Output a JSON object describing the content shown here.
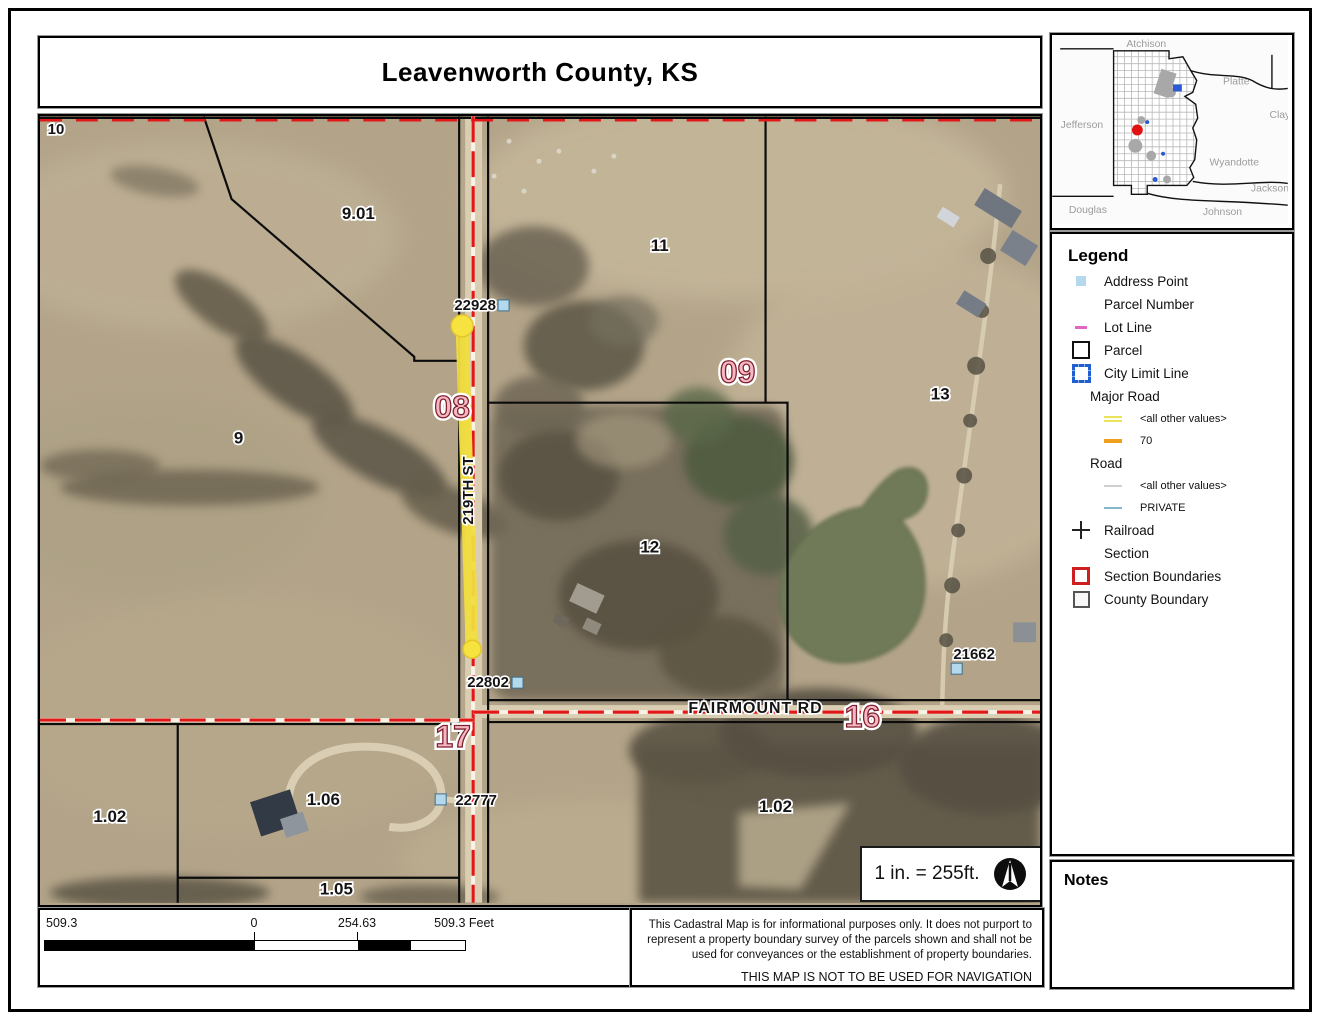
{
  "title": "Leavenworth County, KS",
  "inset": {
    "counties": [
      "Atchison",
      "Platte",
      "Jefferson",
      "Clay",
      "Wyandotte",
      "Jackson",
      "Douglas",
      "Johnson"
    ]
  },
  "legend": {
    "heading": "Legend",
    "items": [
      {
        "label": "Address Point"
      },
      {
        "label": "Parcel Number"
      },
      {
        "label": "Lot Line"
      },
      {
        "label": "Parcel"
      },
      {
        "label": "City Limit Line"
      },
      {
        "label": "Major Road"
      },
      {
        "label": "<all other values>"
      },
      {
        "label": "70"
      },
      {
        "label": "Road"
      },
      {
        "label": "<all other values>"
      },
      {
        "label": "PRIVATE"
      },
      {
        "label": "Railroad"
      },
      {
        "label": "Section"
      },
      {
        "label": "Section Boundaries"
      },
      {
        "label": "County Boundary"
      }
    ]
  },
  "map": {
    "road_labels": {
      "fairmount": "FAIRMOUNT RD",
      "street219": "219TH ST"
    },
    "section_labels": {
      "s08": "08",
      "s09": "09",
      "s16": "16",
      "s17": "17"
    },
    "parcel_labels": {
      "p10": "10",
      "p901": "9.01",
      "p9": "9",
      "p11": "11",
      "p13": "13",
      "p12": "12",
      "p102w": "1.02",
      "p106": "1.06",
      "p105": "1.05",
      "p102e": "1.02"
    },
    "address_labels": {
      "a22928": "22928",
      "a22802": "22802",
      "a21662": "21662",
      "a22777": "22777"
    }
  },
  "scale_note": "1 in. = 255ft.",
  "scalebar": {
    "left": "509.3",
    "zero": "0",
    "mid": "254.63",
    "right": "509.3 Feet"
  },
  "disclaimer": {
    "body": "This Cadastral Map is for informational purposes only.  It does not purport to represent a property boundary survey of the parcels shown and shall not be used for conveyances or the establishment of property boundaries.",
    "warning": "THIS MAP IS NOT TO BE USED FOR NAVIGATION"
  },
  "notes_heading": "Notes",
  "colors": {
    "section_boundary_red": "#e21717",
    "section_label_pink": "#f5b8c2",
    "highlight_yellow": "#f2dd3e",
    "address_point_blue": "#b4d9ed",
    "parcel_line_black": "#0c0c0c",
    "locator_dot_red": "#e01111"
  }
}
